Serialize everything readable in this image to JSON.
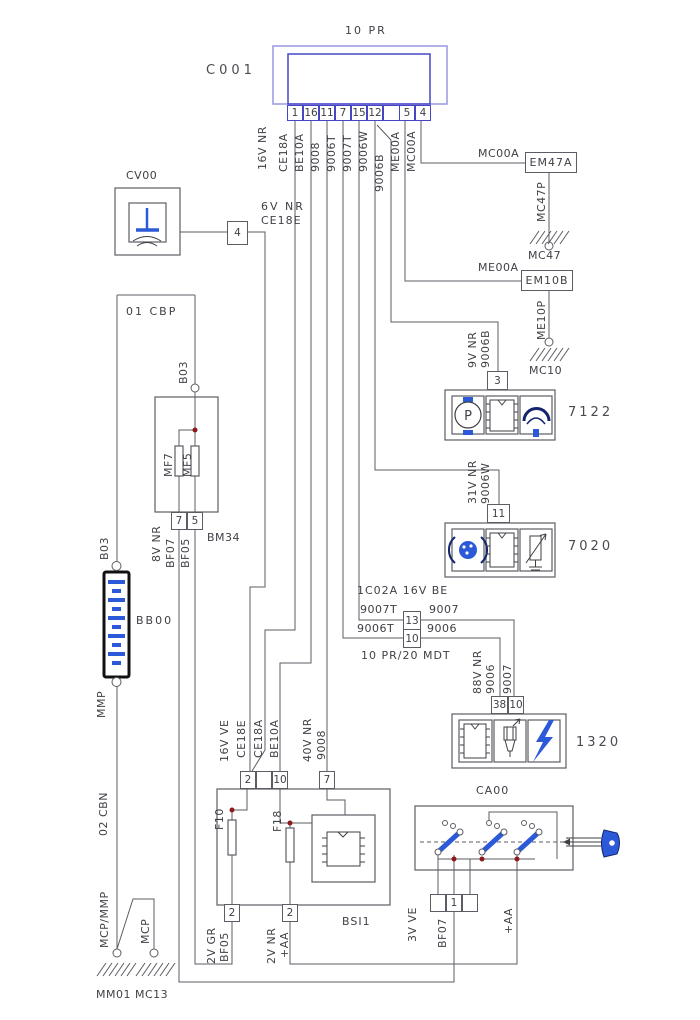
{
  "colors": {
    "accent_blue": "#2b59d8",
    "connector_blue": "#4646c4",
    "wire_gray": "#5c5c64",
    "junction_red": "#8c1a1a"
  },
  "c001": {
    "harness": "10 PR",
    "name": "C001",
    "pins": [
      "1",
      "16",
      "11",
      "7",
      "15",
      "12",
      "",
      "5",
      "4"
    ],
    "wires": {
      "gauge": "16V NR",
      "w1": "CE18A",
      "w2": "BE10A",
      "w3": "9008",
      "w4": "9006T",
      "w5": "9007T",
      "w6": "9006W",
      "w7": "9006B",
      "w8": "ME00A",
      "w9": "MC00A"
    }
  },
  "cv00": {
    "name": "CV00",
    "pin": "4",
    "gauge": "6V NR",
    "wire": "CE18E"
  },
  "ground_em47a": {
    "wire": "MC00A",
    "tag": "EM47A",
    "drop": "MC47P",
    "ground": "MC47"
  },
  "ground_em10b": {
    "wire": "ME00A",
    "tag": "EM10B",
    "drop": "ME10P",
    "ground": "MC10"
  },
  "comp7122": {
    "name": "7122",
    "pin": "3",
    "gauge": "9V NR",
    "wire": "9006B"
  },
  "comp7020": {
    "name": "7020",
    "pin": "11",
    "gauge": "31V NR",
    "wire": "9006W"
  },
  "conn1c02a": {
    "title": "1C02A 16V BE",
    "pin_top": "13",
    "pin_bottom": "10",
    "in_top": "9007T",
    "out_top": "9007",
    "in_bottom": "9006T",
    "out_bottom": "9006",
    "note": "10 PR/20 MDT"
  },
  "comp1320": {
    "name": "1320",
    "gauge": "88V NR",
    "wire_left": "9006",
    "wire_right": "9007",
    "pin_left": "38",
    "pin_right": "10"
  },
  "left": {
    "harness_top": "01 CBP",
    "b03_right": "B03",
    "b03_left": "B03",
    "battery": "BB00",
    "mmp": "MMP",
    "harness_bottom": "02 CBN",
    "mcp_mmp": "MCP/MMP",
    "mcp": "MCP",
    "ground1": "MM01",
    "ground2": "MC13"
  },
  "bm34": {
    "name": "BM34",
    "fuse1": "MF7",
    "fuse2": "MF5",
    "pin1": "7",
    "pin2": "5",
    "gauge": "8V NR",
    "wire1": "BF07",
    "wire2": "BF05"
  },
  "bsi": {
    "name": "BSI1",
    "top_pin1": "2",
    "top_pin2": "10",
    "top_pin3": "7",
    "gauge1": "16V VE",
    "wire1": "CE18E",
    "wire2": "CE18A",
    "wire3": "BE10A",
    "gauge2": "40V NR",
    "wire4": "9008",
    "fuse1": "F10",
    "fuse2": "F18",
    "bottom_pin1": "2",
    "bottom_pin2": "2",
    "bgauge1": "2V GR",
    "bwire1": "BF05",
    "bgauge2": "2V NR",
    "bwire2": "+AA"
  },
  "ca00": {
    "name": "CA00",
    "pin": "1",
    "gauge": "3V VE",
    "wire": "BF07",
    "plus_aa": "+AA"
  },
  "icons": {
    "p_symbol": "P"
  }
}
